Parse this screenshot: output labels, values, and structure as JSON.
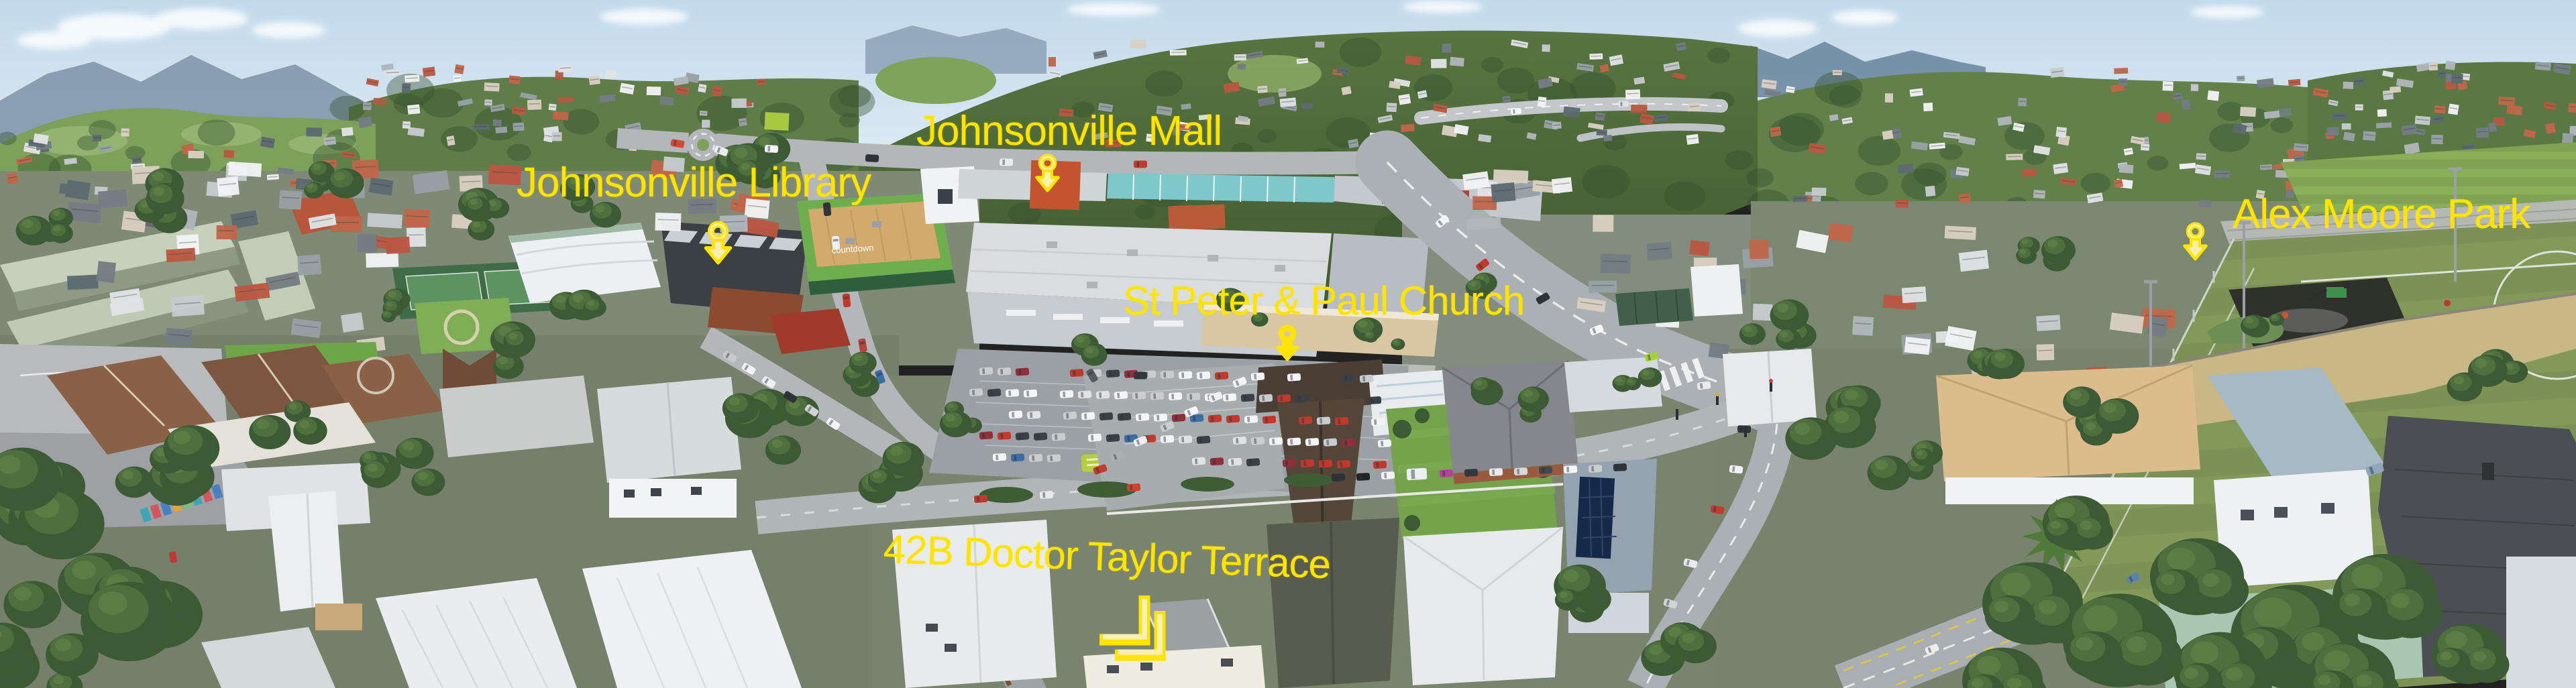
{
  "photo": {
    "annotation_color": "#ffe400",
    "annotation_fill": "#fcf0ae"
  },
  "labels": [
    {
      "id": "johnsonville-library",
      "text": "Johnsonville Library",
      "icon": "map-pin-icon"
    },
    {
      "id": "johnsonville-mall",
      "text": "Johnsonville Mall",
      "icon": "map-pin-icon"
    },
    {
      "id": "st-peter-paul-church",
      "text": "St Peter & Paul Church",
      "icon": "map-pin-icon"
    },
    {
      "id": "alex-moore-park",
      "text": "Alex Moore Park",
      "icon": "map-pin-icon"
    },
    {
      "id": "property-42b",
      "text": "42B Doctor Taylor Terrace",
      "icon": "double-chevron-icon"
    }
  ],
  "building_signs": [
    {
      "id": "countdown-supermarket",
      "text": "countdown"
    }
  ]
}
